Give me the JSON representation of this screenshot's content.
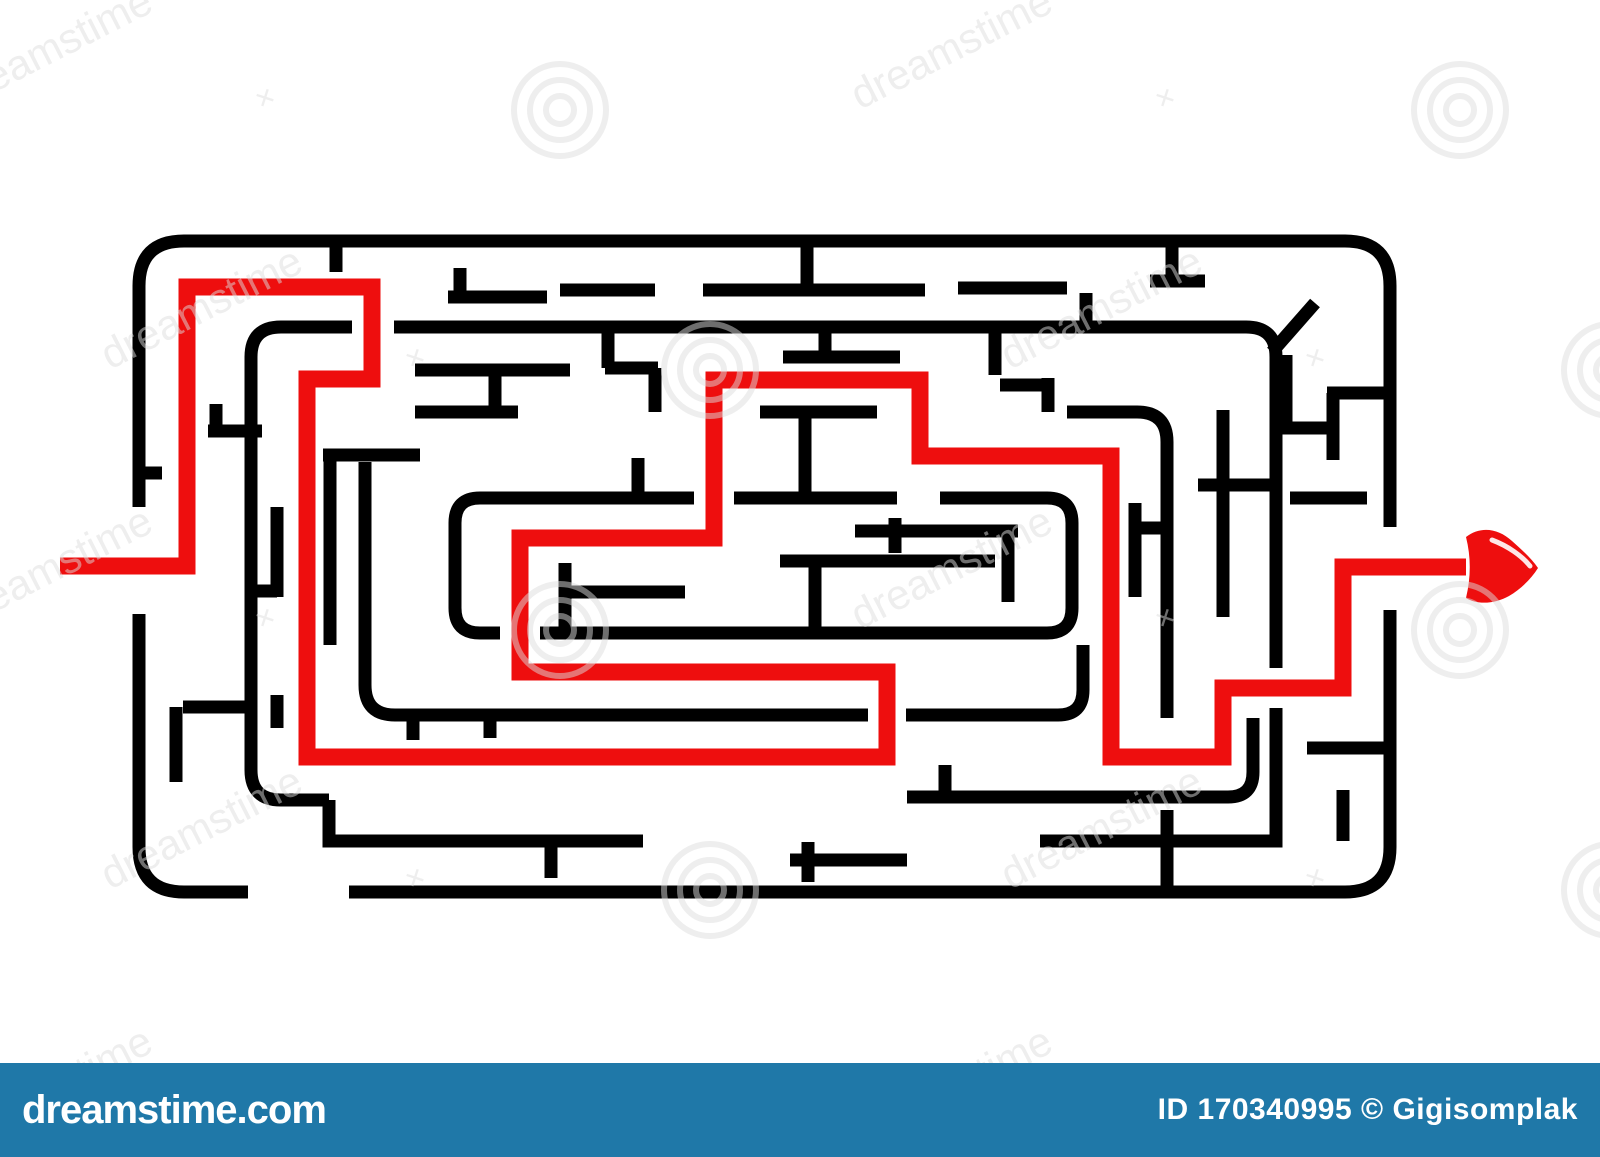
{
  "image": {
    "width": 1600,
    "height": 1157,
    "background": "#ffffff"
  },
  "maze": {
    "wall_color": "#000000",
    "wall_width": 13,
    "border_paths": [
      "M 139 507 V 286 Q 139 241 184 241 H 1345 Q 1390 241 1390 286 V 527",
      "M 1390 610 V 847 Q 1390 892 1345 892 H 349",
      "M 248 892 H 184 Q 139 892 139 847 V 614",
      "M 352 327 H 281 Q 251 327 251 357 V 770 Q 251 800 281 800 H 329",
      "M 394 327 H 1246 Q 1276 327 1276 357 V 668",
      "M 329 800 V 841 H 643",
      "M 1040 841 H 1276 V 708",
      "M 492 498 H 480 Q 455 498 455 523 V 608 Q 455 633 480 633 H 500",
      "M 940 498 H 1047 Q 1072 498 1072 523 V 608 Q 1072 633 1047 633 H 540",
      "M 365 462 V 685 Q 365 715 395 715 H 868",
      "M 906 715 H 1058 Q 1083 715 1083 690 V 645",
      "M 1067 412 H 1137 Q 1167 412 1167 442 V 718",
      "M 907 797 H 1228 Q 1253 797 1253 772 V 718"
    ],
    "wall_segments": [
      [
        807,
        241,
        807,
        290
      ],
      [
        703,
        290,
        925,
        290
      ],
      [
        958,
        288,
        1067,
        288
      ],
      [
        560,
        290,
        655,
        290
      ],
      [
        1172,
        241,
        1172,
        281
      ],
      [
        1150,
        281,
        1205,
        281
      ],
      [
        460,
        268,
        460,
        297
      ],
      [
        448,
        297,
        547,
        297
      ],
      [
        1086,
        293,
        1086,
        331
      ],
      [
        336,
        241,
        336,
        272
      ],
      [
        608,
        331,
        608,
        368
      ],
      [
        605,
        368,
        658,
        368
      ],
      [
        655,
        368,
        655,
        412
      ],
      [
        825,
        331,
        825,
        357
      ],
      [
        783,
        357,
        900,
        357
      ],
      [
        995,
        331,
        995,
        375
      ],
      [
        1000,
        385,
        1052,
        385
      ],
      [
        1048,
        378,
        1048,
        412
      ],
      [
        415,
        370,
        570,
        370
      ],
      [
        495,
        370,
        495,
        412
      ],
      [
        415,
        412,
        518,
        412
      ],
      [
        760,
        412,
        877,
        412
      ],
      [
        805,
        412,
        805,
        498
      ],
      [
        638,
        458,
        638,
        498
      ],
      [
        323,
        455,
        420,
        455
      ],
      [
        492,
        498,
        694,
        498
      ],
      [
        734,
        498,
        897,
        498
      ],
      [
        855,
        531,
        1018,
        531
      ],
      [
        895,
        518,
        895,
        553
      ],
      [
        1008,
        531,
        1008,
        602
      ],
      [
        780,
        561,
        995,
        561
      ],
      [
        815,
        561,
        815,
        627
      ],
      [
        565,
        563,
        565,
        628
      ],
      [
        567,
        592,
        685,
        592
      ],
      [
        1135,
        503,
        1135,
        597
      ],
      [
        1140,
        528,
        1163,
        528
      ],
      [
        1223,
        410,
        1223,
        617
      ],
      [
        1198,
        485,
        1280,
        485
      ],
      [
        1290,
        498,
        1367,
        498
      ],
      [
        1282,
        428,
        1328,
        428
      ],
      [
        1333,
        393,
        1333,
        460
      ],
      [
        1327,
        393,
        1384,
        393
      ],
      [
        1286,
        355,
        1286,
        428
      ],
      [
        208,
        431,
        262,
        431
      ],
      [
        216,
        404,
        216,
        431
      ],
      [
        277,
        507,
        277,
        597
      ],
      [
        251,
        591,
        277,
        591
      ],
      [
        330,
        460,
        330,
        645
      ],
      [
        139,
        473,
        162,
        473
      ],
      [
        183,
        707,
        245,
        707
      ],
      [
        176,
        707,
        176,
        782
      ],
      [
        277,
        695,
        277,
        728
      ],
      [
        413,
        715,
        413,
        740
      ],
      [
        490,
        715,
        490,
        738
      ],
      [
        551,
        841,
        551,
        878
      ],
      [
        808,
        842,
        808,
        882
      ],
      [
        790,
        860,
        907,
        860
      ],
      [
        945,
        765,
        945,
        800
      ],
      [
        1167,
        810,
        1167,
        890
      ],
      [
        1343,
        790,
        1343,
        841
      ],
      [
        1307,
        748,
        1390,
        748
      ],
      [
        1272,
        352,
        1315,
        303
      ]
    ],
    "solution": {
      "color": "#ee0e0e",
      "width": 17,
      "points": "60,566 187,566 187,287 372,287 372,379 307,379 307,757 887,757 887,672 520,672 520,538 714,538 714,380 920,380 920,456 1111,456 1111,757 1223,757 1223,688 1343,688 1343,567 1466,567",
      "arrowhead": "M 1466 537 C 1480 526 1498 528 1512 541 C 1522 550 1532 559 1538 568 C 1531 579 1521 589 1509 596 C 1495 604 1477 605 1466 598 C 1471 577 1471 557 1466 537 Z",
      "arrow_gloss": "M 1492 540 C 1508 546 1522 556 1530 566"
    }
  },
  "watermark": {
    "tile_text": "dreamstime",
    "cross_glyph": "✕",
    "tile_color": "#dcdcdc",
    "tile_opacity": 0.5,
    "bar": {
      "background": "#1f78a8",
      "site": "dreamstime.com",
      "credit": "ID 170340995 © Gigisomplak"
    }
  }
}
